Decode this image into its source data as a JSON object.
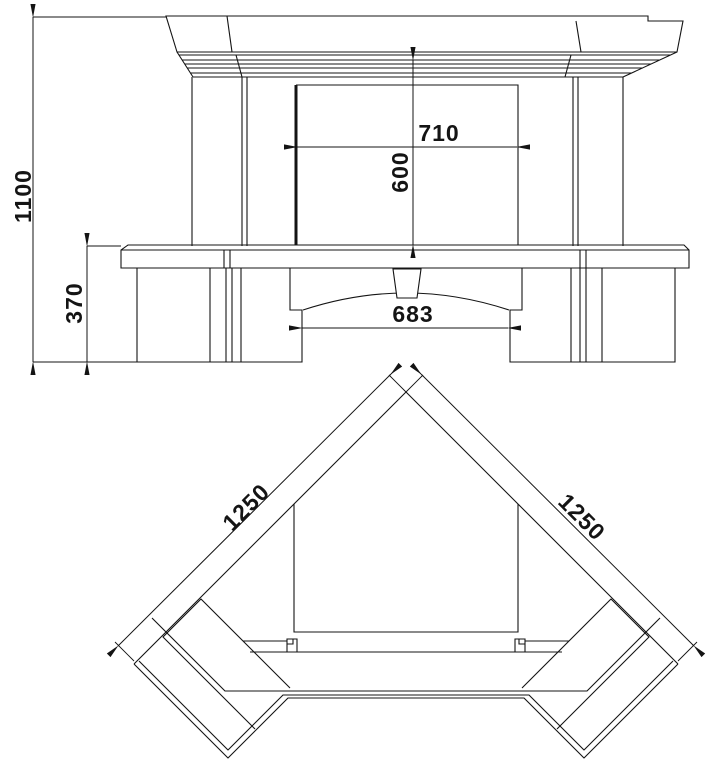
{
  "drawing": {
    "colors": {
      "background": "#ffffff",
      "line": "#141414"
    },
    "dim_labels": {
      "total_height": "1100",
      "plinth_height": "370",
      "opening_width": "710",
      "opening_height": "600",
      "hearth_opening_width": "683",
      "left_flank_length": "1250",
      "right_flank_length": "1250"
    }
  }
}
